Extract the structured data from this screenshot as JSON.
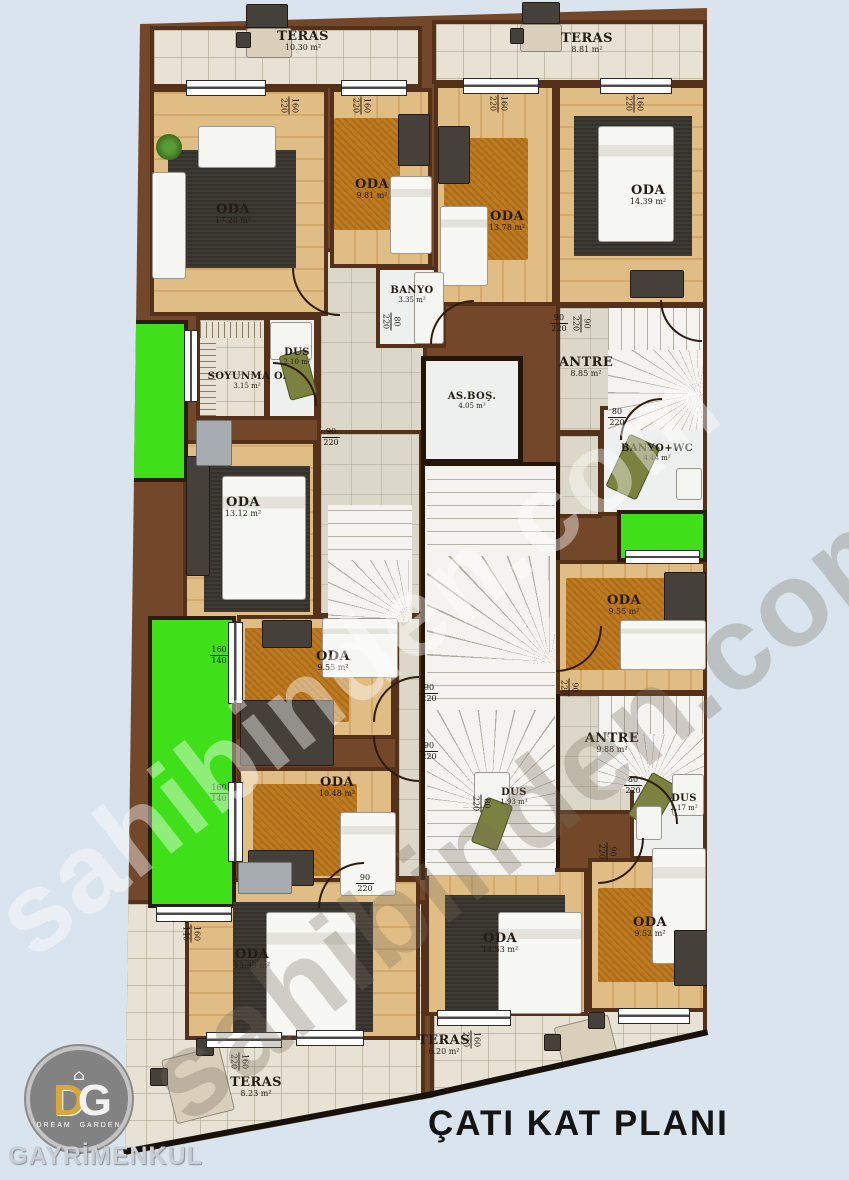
{
  "title": "ÇATI KAT PLANI",
  "watermark": {
    "text": "sahibinden.com"
  },
  "logo": {
    "d": "D",
    "g": "G",
    "house": "⌂",
    "dream": "DREAM",
    "garden": "GARDEN",
    "company": "GAYRİMENKUL"
  },
  "colors": {
    "background": "#d9e4ee",
    "wall_brown": "#73482a",
    "balcony_green": "#3fe01a",
    "wood_floor": "#dfbc82",
    "carpet_orange": "#bd7a20",
    "tile_floor": "#e7e2d4",
    "title_text": "#141414",
    "logo_gold": "#d9a63c"
  },
  "rooms": [
    {
      "name": "TERAS",
      "area": "10.30 m²"
    },
    {
      "name": "TERAS",
      "area": "8.81 m²"
    },
    {
      "name": "ODA",
      "area": "17.28 m²"
    },
    {
      "name": "ODA",
      "area": "9.81 m²"
    },
    {
      "name": "ODA",
      "area": "13.78 m²"
    },
    {
      "name": "ODA",
      "area": "14.39 m²"
    },
    {
      "name": "BANYO",
      "area": "3.35 m²"
    },
    {
      "name": "SOYUNMA O.",
      "area": "3.15 m²"
    },
    {
      "name": "DUS",
      "area": "2.10 m²"
    },
    {
      "name": "ANTRE",
      "area": "8.85 m²"
    },
    {
      "name": "AS.BOŞ.",
      "area": "4.05 m²"
    },
    {
      "name": "BANYO+WC",
      "area": "4.44 m²"
    },
    {
      "name": "ODA",
      "area": "13.12 m²"
    },
    {
      "name": "ODA",
      "area": "9.55 m²"
    },
    {
      "name": "ODA",
      "area": "9.55 m²"
    },
    {
      "name": "ANTRE",
      "area": "9.88 m²"
    },
    {
      "name": "ODA",
      "area": "10.48 m²"
    },
    {
      "name": "DUS",
      "area": "1.93 m²"
    },
    {
      "name": "DUS",
      "area": "2.17 m²"
    },
    {
      "name": "ODA",
      "area": "9.52 m²"
    },
    {
      "name": "ODA",
      "area": "13.33 m²"
    },
    {
      "name": "ODA",
      "area": "14.53 m²"
    },
    {
      "name": "TERAS",
      "area": "8.23 m²"
    },
    {
      "name": "TERAS",
      "area": "6.20 m²"
    }
  ],
  "dims": [
    {
      "a": "160",
      "b": "220"
    },
    {
      "a": "160",
      "b": "220"
    },
    {
      "a": "160",
      "b": "220"
    },
    {
      "a": "160",
      "b": "220"
    },
    {
      "a": "160",
      "b": "140"
    },
    {
      "a": "160",
      "b": "140"
    },
    {
      "a": "160",
      "b": "220"
    },
    {
      "a": "160",
      "b": "220"
    },
    {
      "a": "90",
      "b": "220"
    },
    {
      "a": "90",
      "b": "220"
    },
    {
      "a": "90",
      "b": "220"
    },
    {
      "a": "80",
      "b": "220"
    },
    {
      "a": "80",
      "b": "220"
    },
    {
      "a": "90",
      "b": "220"
    },
    {
      "a": "90",
      "b": "220"
    },
    {
      "a": "90",
      "b": "220"
    },
    {
      "a": "80",
      "b": "220"
    },
    {
      "a": "80",
      "b": "220"
    },
    {
      "a": "90",
      "b": "220"
    },
    {
      "a": "90",
      "b": "220"
    },
    {
      "a": "160",
      "b": "140"
    }
  ]
}
